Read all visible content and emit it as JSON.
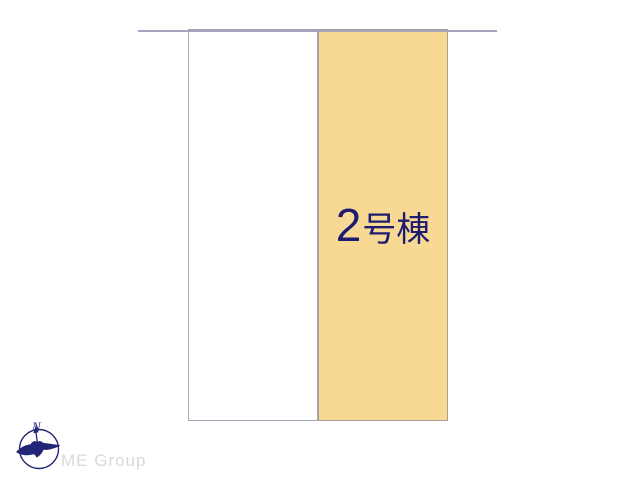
{
  "page": {
    "background": "#ffffff",
    "type": "real-estate-site-plan"
  },
  "site_plan": {
    "road_line_color": "#a4a4bc",
    "lots": [
      {
        "name": "vacant-lot",
        "label_number": "",
        "label_suffix": "",
        "label_full": "",
        "fill": "#ffffff",
        "border": "#a8a6b8"
      },
      {
        "name": "building-2-lot",
        "label_number": "2",
        "label_suffix": "号棟",
        "label_full": "2号棟",
        "fill": "#f8d994",
        "border": "#a89e96",
        "label_color": "#1e1b70"
      }
    ]
  },
  "branding": {
    "company": "ME Group",
    "company_color": "#d9d9d9",
    "logo": {
      "icon": "compass-bird-logo",
      "compass_letter": "N",
      "color": "#232677"
    }
  }
}
